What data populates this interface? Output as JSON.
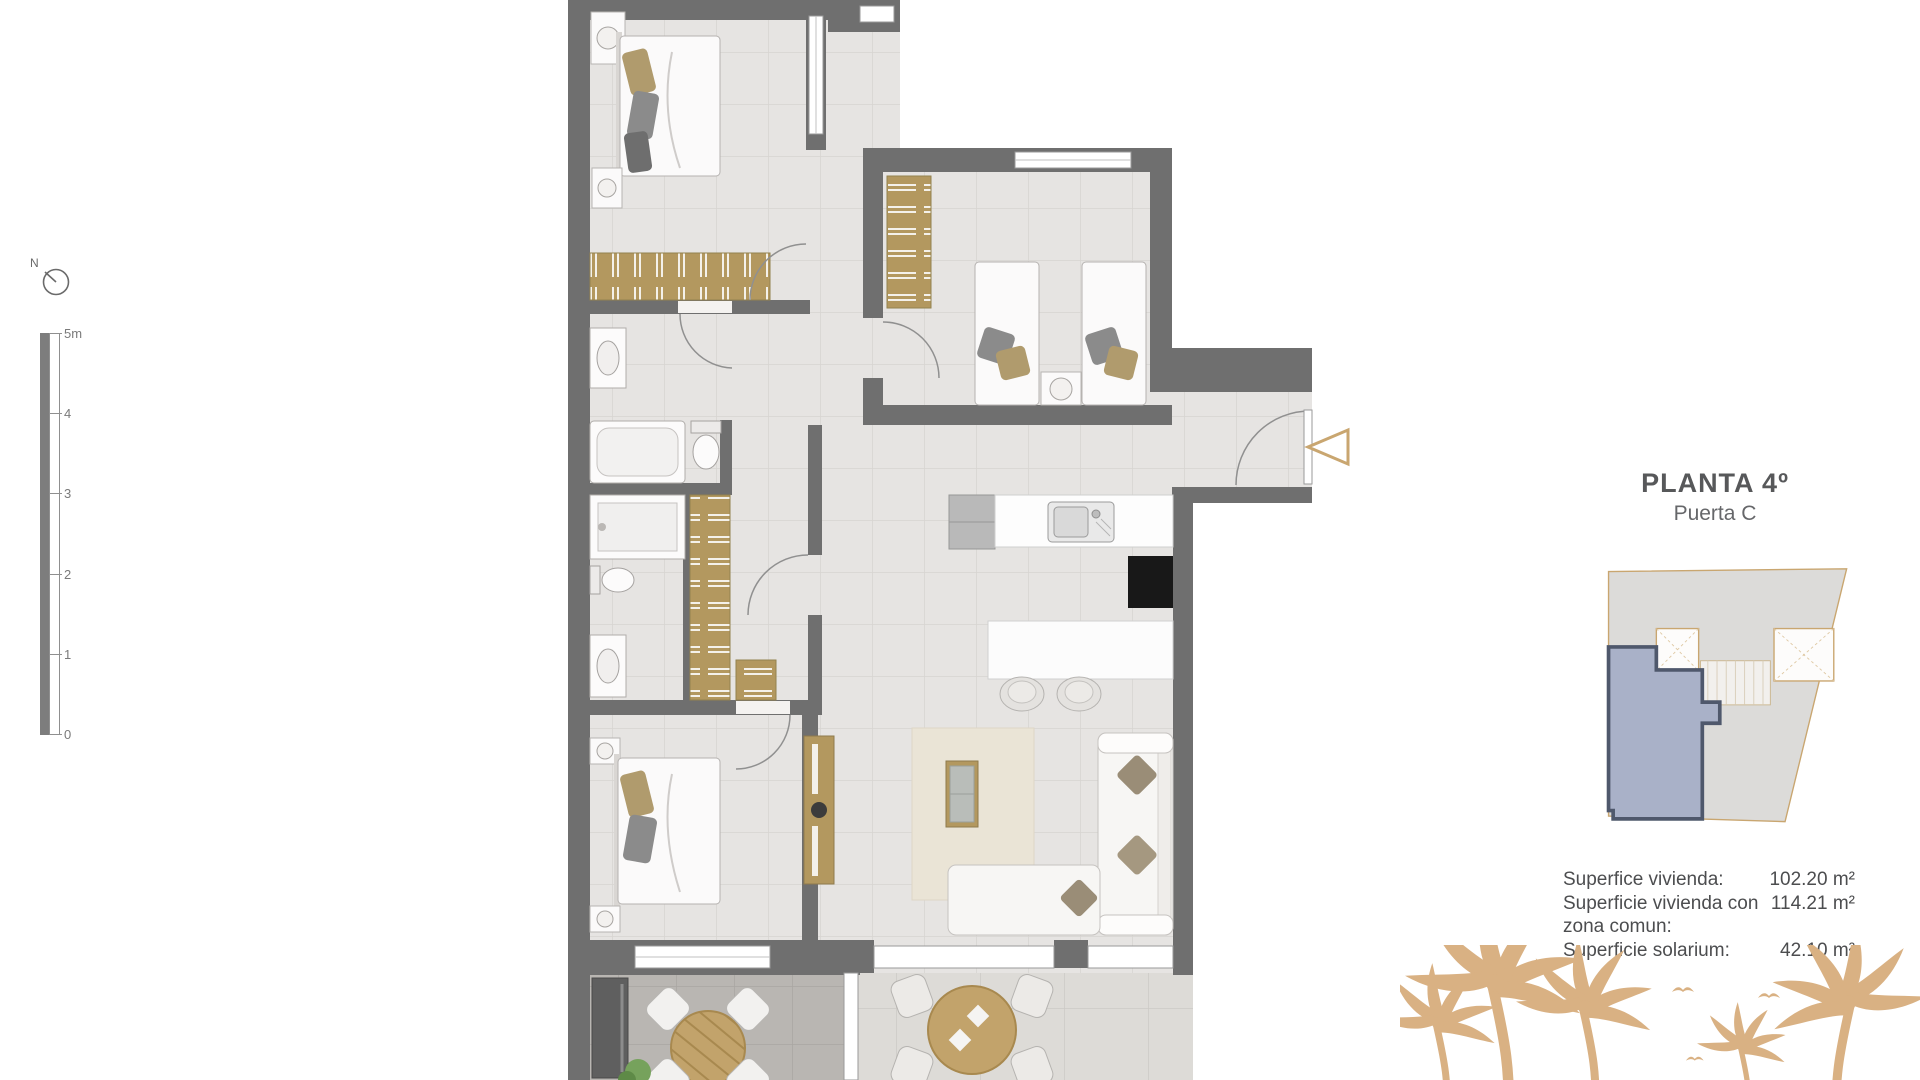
{
  "header": {
    "title": "PLANTA 4º",
    "subtitle": "Puerta C"
  },
  "areas": [
    {
      "label": "Superfice vivienda:",
      "value": "102.20 m²"
    },
    {
      "label": "Superficie vivienda con zona comun:",
      "value": "114.21 m²"
    },
    {
      "label": "Superficie solarium:",
      "value": "42.10 m²"
    }
  ],
  "scale": {
    "ticks": [
      "5m",
      "4",
      "3",
      "2",
      "1",
      "0"
    ]
  },
  "compass": {
    "label": "N"
  },
  "colors": {
    "wall": "#6f6f6f",
    "wood": "#b3985f",
    "accent": "#c9a670",
    "keyplan_unit": "#a9b1c8",
    "keyplan_unit_border": "#4f586c",
    "palm": "#d9b183"
  }
}
